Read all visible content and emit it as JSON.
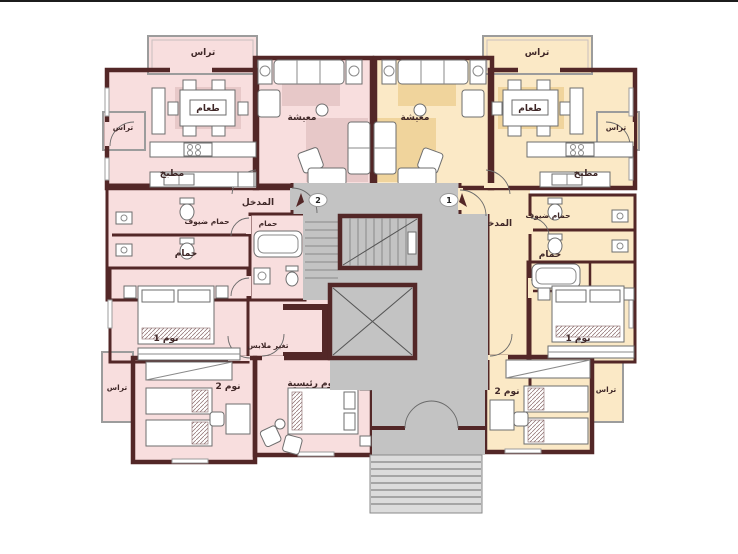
{
  "page": {
    "background": "#ffffff",
    "top_border_color": "#1c1c1c"
  },
  "colors": {
    "wall": "#532727",
    "pink": "#f8dede",
    "pink_rug": "#e7c8c8",
    "yellow": "#fbe9c6",
    "yellow_rug": "#f0d49c",
    "gray": "#c3c3c3",
    "steps": "#dcdcdc",
    "label": "#3f2727"
  },
  "units": {
    "left": {
      "number": "2",
      "labels": {
        "terrace_top": "تراس",
        "terrace_side": "تراس",
        "terrace_bottom": "تراس",
        "dining": "طعام",
        "living": "معيشة",
        "kitchen": "مطبخ",
        "entrance": "المدخل",
        "guest_bath": "حمام ضيوف",
        "bath": "حمام",
        "main_bath": "حمام",
        "bedroom1": "نوم 1",
        "bedroom2": "نوم 2",
        "master_bedroom": "نوم رئيسية",
        "dressing": "تغير ملابس"
      }
    },
    "right": {
      "number": "1",
      "labels": {
        "terrace_top": "تراس",
        "terrace_side": "تراس",
        "terrace_bottom": "تراس",
        "dining": "طعام",
        "living": "معيشة",
        "kitchen": "مطبخ",
        "entrance": "المدخل",
        "guest_bath": "حمام ضيوف",
        "bath": "حمام",
        "bedroom1": "نوم 1",
        "bedroom2": "نوم 2"
      }
    }
  }
}
